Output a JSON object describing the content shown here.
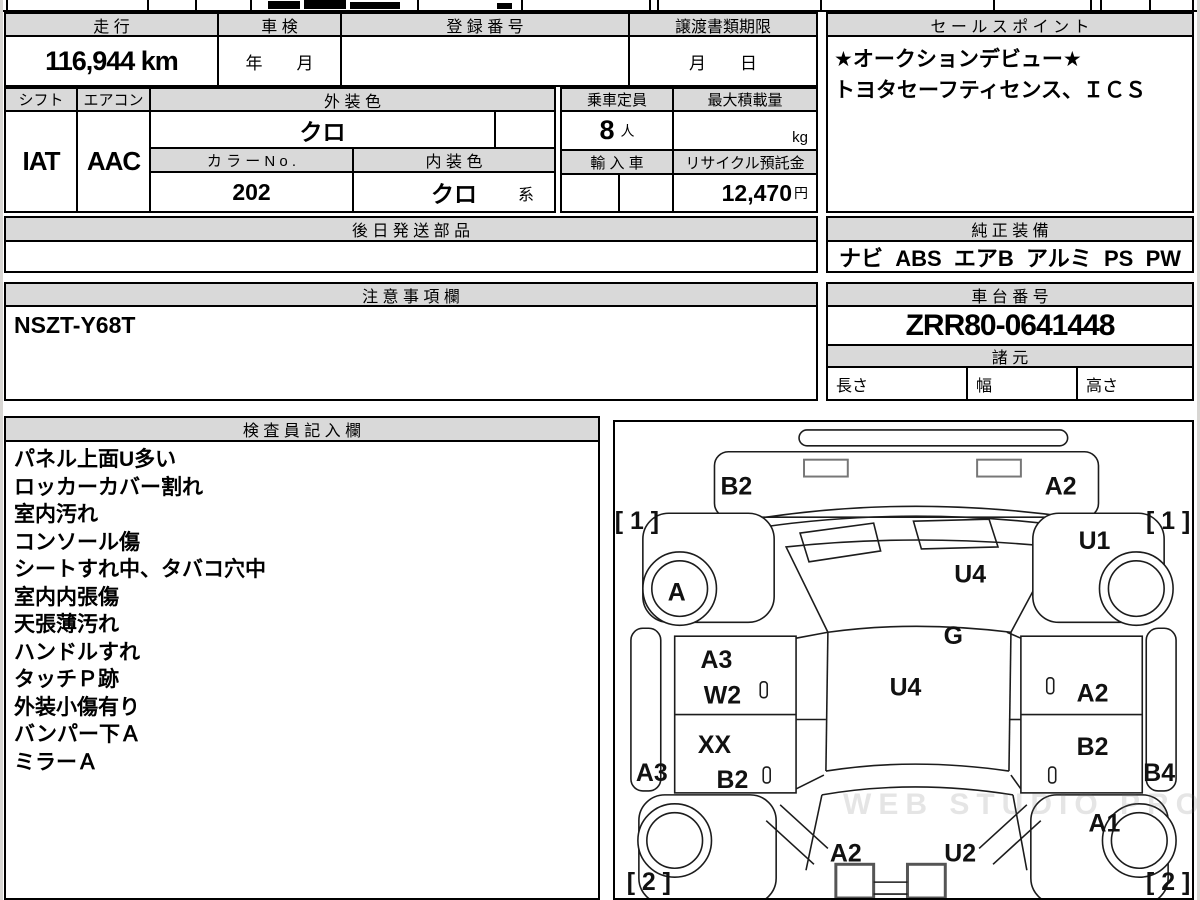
{
  "table": {
    "mileage_label": "走 行",
    "mileage_value": "116,944 km",
    "shaken_label": "車 検",
    "shaken_value": "年　　月",
    "reg_label": "登 録 番 号",
    "reg_value": "",
    "deadline_label": "譲渡書類期限",
    "deadline_value": "月　　日",
    "shift_label": "シフト",
    "shift_value": "IAT",
    "aircon_label": "エアコン",
    "aircon_value": "AAC",
    "ext_color_label": "外 装 色",
    "ext_color_value": "クロ",
    "capacity_label": "乗車定員",
    "capacity_value": "8",
    "capacity_unit": "人",
    "max_load_label": "最大積載量",
    "max_load_unit": "kg",
    "color_no_label": "カ ラ ー N o .",
    "color_no_value": "202",
    "int_color_label": "内 装 色",
    "int_color_value": "クロ",
    "int_color_suffix": "系",
    "import_label": "輸 入 車",
    "recycle_label": "リサイクル預託金",
    "recycle_value": "12,470",
    "recycle_unit": "円",
    "later_parts_label": "後 日 発 送 部 品"
  },
  "sales_point": {
    "title": "セ ー ル ス ポ イ ン ト",
    "lines": [
      "★オークションデビュー★",
      "トヨタセーフティセンス、ＩＣＳ"
    ]
  },
  "equipment": {
    "title": "純 正 装 備",
    "value": "ナビ  ABS  エアB  アルミ  PS  PW"
  },
  "notes": {
    "title": "注 意 事 項 欄",
    "value": "NSZT-Y68T"
  },
  "chassis": {
    "title": "車 台 番 号",
    "value": "ZRR80-0641448",
    "spec_title": "諸 元",
    "length_label": "長さ",
    "width_label": "幅",
    "height_label": "高さ"
  },
  "inspector": {
    "title": "検 査 員 記 入 欄",
    "items": [
      "パネル上面U多い",
      "ロッカーカバー割れ",
      "室内汚れ",
      "コンソール傷",
      "シートすれ中、タバコ穴中",
      "室内内張傷",
      "天張薄汚れ",
      "ハンドルすれ",
      "タッチＰ跡",
      "外装小傷有り",
      "バンパー下Ａ",
      "ミラーＡ"
    ]
  },
  "diagram": {
    "labels": [
      {
        "t": "B2",
        "x": 122,
        "y": 73
      },
      {
        "t": "A2",
        "x": 448,
        "y": 73
      },
      {
        "t": "[ 1 ]",
        "x": 22,
        "y": 108
      },
      {
        "t": "[ 1 ]",
        "x": 556,
        "y": 108
      },
      {
        "t": "U1",
        "x": 482,
        "y": 128
      },
      {
        "t": "A",
        "x": 62,
        "y": 180
      },
      {
        "t": "U4",
        "x": 357,
        "y": 162
      },
      {
        "t": "G",
        "x": 340,
        "y": 224
      },
      {
        "t": "A3",
        "x": 102,
        "y": 248
      },
      {
        "t": "W2",
        "x": 108,
        "y": 284
      },
      {
        "t": "U4",
        "x": 292,
        "y": 276
      },
      {
        "t": "A2",
        "x": 480,
        "y": 282
      },
      {
        "t": "XX",
        "x": 100,
        "y": 334
      },
      {
        "t": "B2",
        "x": 118,
        "y": 369
      },
      {
        "t": "B2",
        "x": 480,
        "y": 336
      },
      {
        "t": "A3",
        "x": 37,
        "y": 362
      },
      {
        "t": "B4",
        "x": 547,
        "y": 362
      },
      {
        "t": "A1",
        "x": 492,
        "y": 413
      },
      {
        "t": "A2",
        "x": 232,
        "y": 443
      },
      {
        "t": "U2",
        "x": 347,
        "y": 443
      },
      {
        "t": "[ 2 ]",
        "x": 34,
        "y": 472
      },
      {
        "t": "[ 2 ]",
        "x": 556,
        "y": 472
      }
    ]
  },
  "watermark": "WEB STUDIO PRO"
}
